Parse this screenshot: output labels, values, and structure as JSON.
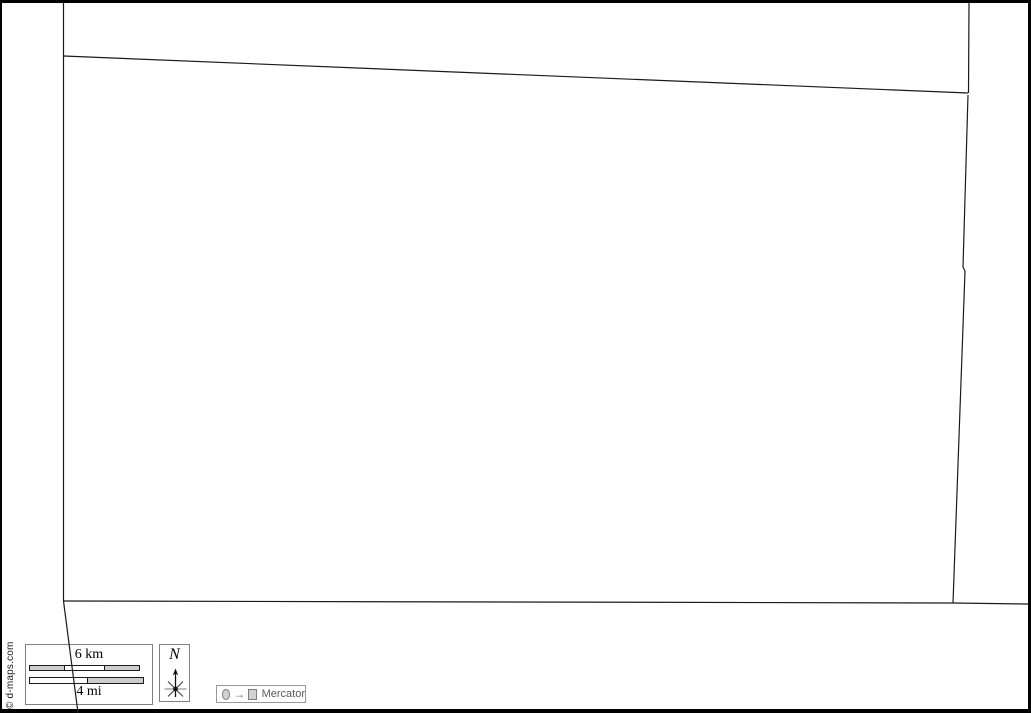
{
  "source_credit": {
    "text": "© d-maps.com"
  },
  "scale_bar": {
    "km_label": "6 km",
    "mi_label": "4 mi"
  },
  "compass": {
    "north_label": "N"
  },
  "projection": {
    "label": "Mercator",
    "arrow_glyph": "→"
  },
  "colors": {
    "frame": "#000000",
    "boundary_line": "#1a1a1a",
    "legend_box_border": "#808080",
    "scale_bar_gray": "#cdcdcd",
    "scale_bar_white": "#ffffff",
    "projection_text": "#5a5a5a"
  },
  "map": {
    "projection_name": "Mercator",
    "boundaries": [
      {
        "name": "west-border",
        "points": "63.5,3 63.5,601"
      },
      {
        "name": "west-border-lower",
        "points": "63.5,601 78,713"
      },
      {
        "name": "north-border",
        "points": "63.5,56 968,93"
      },
      {
        "name": "northeast-border",
        "points": "969,3 968.5,93"
      },
      {
        "name": "east-border",
        "points": "968,95 963,267 965,271 953,603"
      },
      {
        "name": "south-border",
        "points": "63.5,601 953,603 1028,604"
      }
    ]
  }
}
